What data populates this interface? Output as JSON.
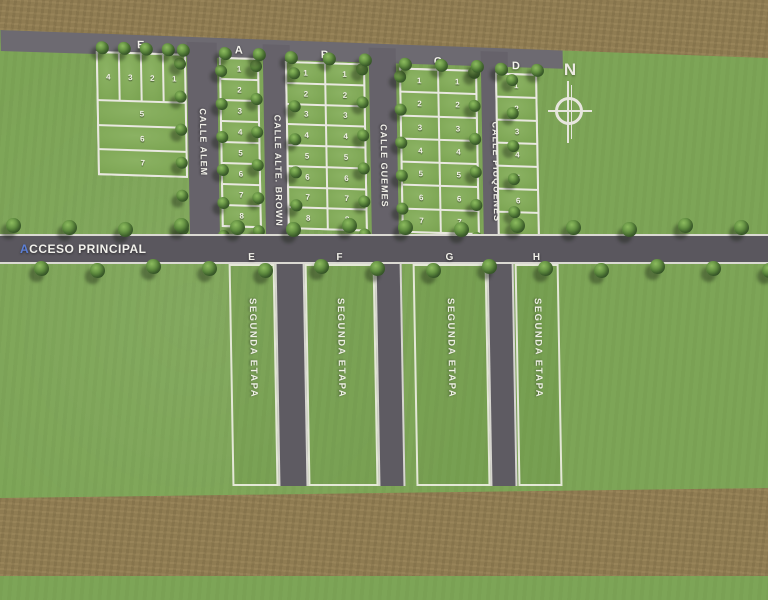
{
  "map": {
    "access_road_label": "ACCESO PRINCIPAL",
    "compass_label": "N",
    "streets": [
      {
        "id": "alem",
        "label": "CALLE ALEM"
      },
      {
        "id": "brown",
        "label": "CALLE ALTE. BROWN"
      },
      {
        "id": "guemes",
        "label": "CALLE GUEMES"
      },
      {
        "id": "piuquenes",
        "label": "CALLE PIUQUENES"
      }
    ],
    "blocks": [
      {
        "id": "E",
        "label": "E",
        "type": "mixed",
        "top_row": [
          "4",
          "3",
          "2",
          "1"
        ],
        "strips": [
          "5",
          "6",
          "7"
        ]
      },
      {
        "id": "A",
        "label": "A",
        "type": "columns",
        "columns": [
          [
            "1",
            "2",
            "3",
            "4",
            "5",
            "6",
            "7",
            "8"
          ]
        ]
      },
      {
        "id": "B",
        "label": "B",
        "type": "columns",
        "columns": [
          [
            "1",
            "2",
            "3",
            "4",
            "5",
            "6",
            "7",
            "8"
          ],
          [
            "1",
            "2",
            "3",
            "4",
            "5",
            "6",
            "7",
            "8"
          ]
        ]
      },
      {
        "id": "C",
        "label": "C",
        "type": "columns",
        "columns": [
          [
            "1",
            "2",
            "3",
            "4",
            "5",
            "6",
            "7"
          ],
          [
            "1",
            "2",
            "3",
            "4",
            "5",
            "6",
            "7"
          ]
        ]
      },
      {
        "id": "D",
        "label": "D",
        "type": "columns",
        "columns": [
          [
            "1",
            "2",
            "3",
            "4",
            "5",
            "6",
            "7"
          ]
        ]
      }
    ],
    "phase2": {
      "area_label": "SEGUNDA ETAPA",
      "sections": [
        {
          "id": "E2",
          "label": "E"
        },
        {
          "id": "F2",
          "label": "F"
        },
        {
          "id": "G2",
          "label": "G"
        },
        {
          "id": "H2",
          "label": "H"
        }
      ]
    }
  },
  "colors": {
    "grass": "#7da557",
    "lot_grass": "#83ab5b",
    "dirt": "#8f7c52",
    "asphalt": "#5a575e",
    "line_white": "#e9e8e0",
    "accent_blue": "#5b7fd6"
  }
}
